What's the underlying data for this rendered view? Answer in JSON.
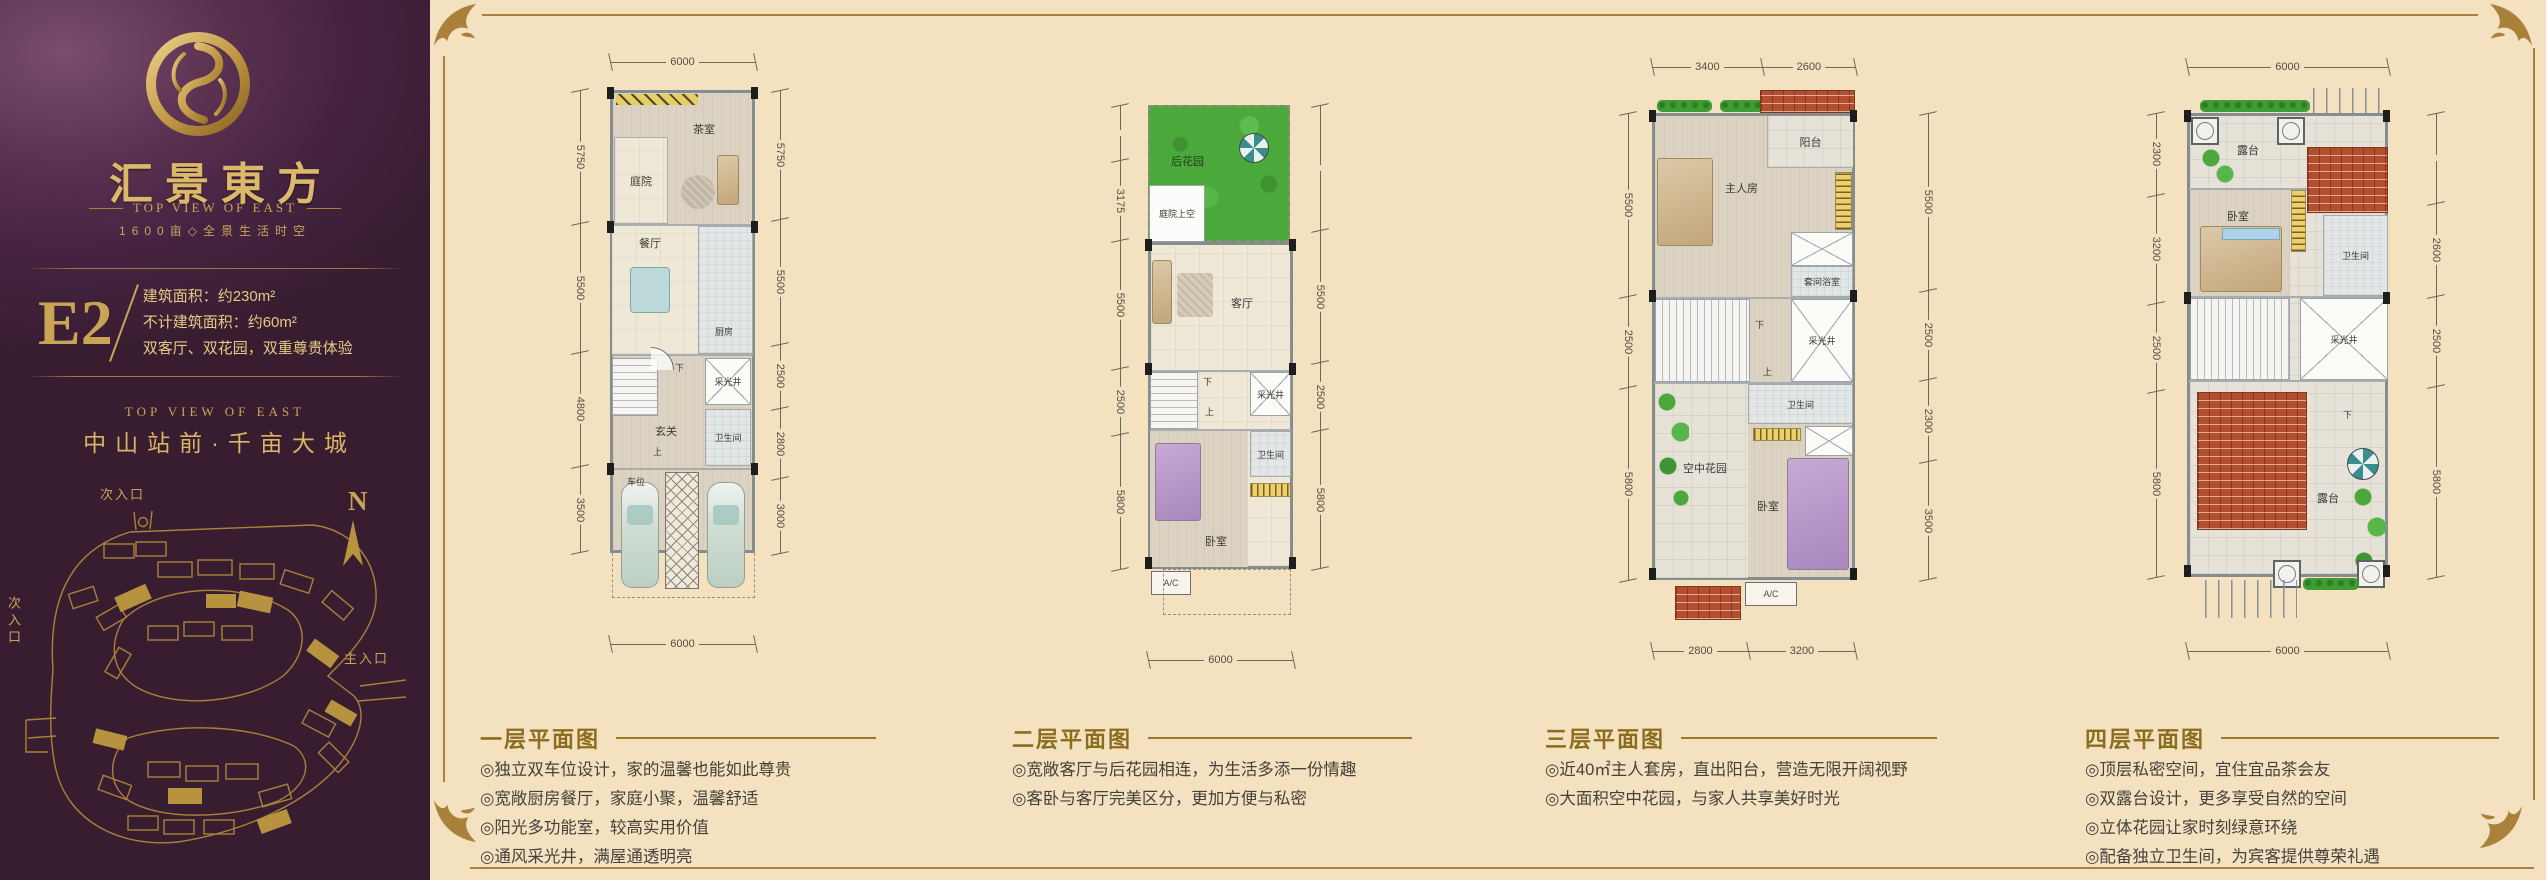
{
  "brand": {
    "title": "汇景東方",
    "subtitle": "TOP VIEW OF EAST",
    "tagline": "1600亩◇全景生活时空"
  },
  "unit": {
    "code": "E2",
    "lines": [
      "建筑面积：约230m²",
      "不计建筑面积：约60m²",
      "双客厅、双花园，双重尊贵体验"
    ]
  },
  "location": {
    "en": "TOP  VIEW  OF  EAST",
    "cn": "中山站前·千亩大城"
  },
  "siteplan": {
    "north": "N",
    "entry_secondary_top": "次入口",
    "entry_secondary_left": "次入口",
    "entry_main": "主入口"
  },
  "colors": {
    "sidebar_purple": "#452340",
    "gold": "#c9a455",
    "beige": "#f3e1c0",
    "frame_gold": "#a9813a",
    "roof_red": "#b34f2e",
    "garden_green": "#4ba93b"
  },
  "plans": [
    {
      "name": "一层",
      "rooms": {
        "tea": "茶室",
        "courtyard": "庭院",
        "dining": "餐厅",
        "kitchen": "厨房",
        "foyer": "玄关",
        "lightwell": "采光井",
        "bath": "卫生间",
        "parking": "车位",
        "down": "下",
        "up": "上"
      },
      "dims": {
        "top": [
          "6000"
        ],
        "bottom": [
          "6000"
        ],
        "left": [
          "5750",
          "5500",
          "4800",
          "3500"
        ],
        "right": [
          "5750",
          "5500",
          "2500",
          "2800",
          "3000"
        ]
      }
    },
    {
      "name": "二层",
      "rooms": {
        "garden": "后花园",
        "court_void": "庭院上空",
        "living": "客厅",
        "down": "下",
        "up": "上",
        "lightwell": "采光井",
        "bath": "卫生间",
        "bed": "卧室",
        "ac": "A/C"
      },
      "dims": {
        "bottom": [
          "6000"
        ],
        "left": [
          "3175",
          "5500",
          "2500",
          "5800"
        ],
        "right": [
          "5500",
          "2500",
          "5800"
        ]
      }
    },
    {
      "name": "三层",
      "rooms": {
        "balcony": "阳台",
        "master": "主人房",
        "ensuite": "套间浴室",
        "down": "下",
        "up": "上",
        "lightwell": "采光井",
        "bath": "卫生间",
        "skygarden": "空中花园",
        "bed": "卧室",
        "ac": "A/C"
      },
      "dims": {
        "top": [
          "3400",
          "2600"
        ],
        "bottom": [
          "2800",
          "3200"
        ],
        "left": [
          "5500",
          "2500",
          "5800"
        ],
        "right": [
          "5500",
          "2500",
          "2300",
          "3500"
        ]
      }
    },
    {
      "name": "四层",
      "rooms": {
        "terrace_top": "露台",
        "bed": "卧室",
        "bath": "卫生间",
        "lightwell": "采光井",
        "terrace": "露台",
        "down": "下"
      },
      "dims": {
        "top": [
          "6000"
        ],
        "bottom": [
          "6000"
        ],
        "left": [
          "2300",
          "3200",
          "2500",
          "5800"
        ],
        "right": [
          "2600",
          "2500",
          "5800"
        ]
      }
    }
  ],
  "captions": [
    {
      "title": "一层平面图",
      "bullets": [
        "◎独立双车位设计，家的温馨也能如此尊贵",
        "◎宽敞厨房餐厅，家庭小聚，温馨舒适",
        "◎阳光多功能室，较高实用价值",
        "◎通风采光井，满屋通透明亮"
      ]
    },
    {
      "title": "二层平面图",
      "bullets": [
        "◎宽敞客厅与后花园相连，为生活多添一份情趣",
        "◎客卧与客厅完美区分，更加方便与私密"
      ]
    },
    {
      "title": "三层平面图",
      "bullets": [
        "◎近40㎡主人套房，直出阳台，营造无限开阔视野",
        "◎大面积空中花园，与家人共享美好时光"
      ]
    },
    {
      "title": "四层平面图",
      "bullets": [
        "◎顶层私密空间，宜住宜品茶会友",
        "◎双露台设计，更多享受自然的空间",
        "◎立体花园让家时刻绿意环绕",
        "◎配备独立卫生间，为宾客提供尊荣礼遇"
      ]
    }
  ]
}
